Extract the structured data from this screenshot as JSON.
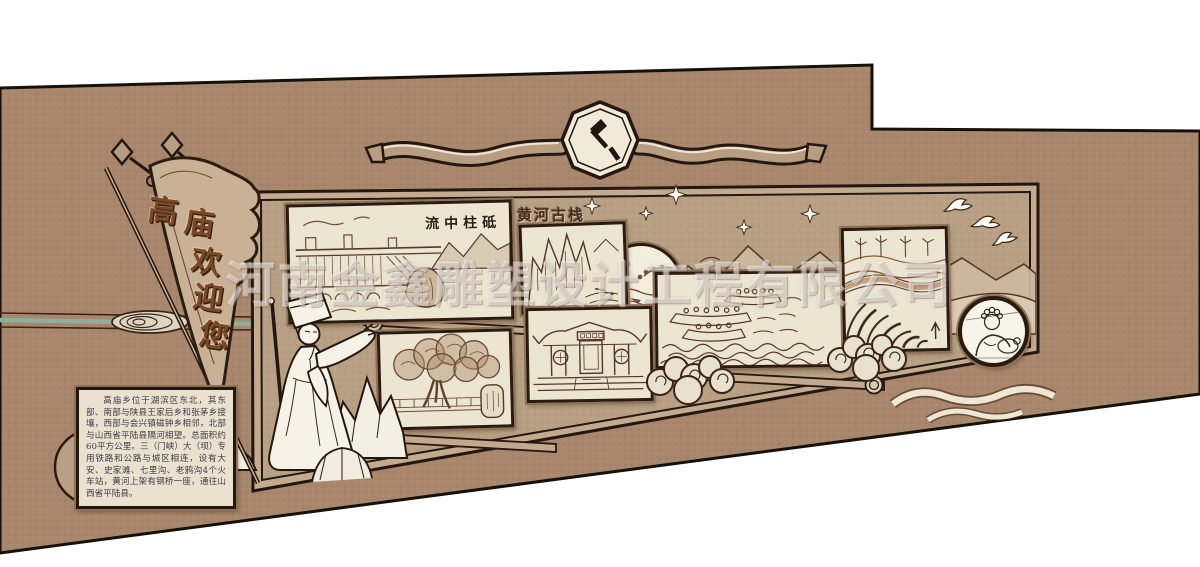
{
  "watermark": {
    "company": "河南金鑫雕塑设计工程有限公司"
  },
  "flag": {
    "text": "高庙欢迎您",
    "chars": [
      "高",
      "庙",
      "欢",
      "迎",
      "您"
    ]
  },
  "banner": {
    "emblem_icon": "hammer-sickle-icon"
  },
  "intro_board": {
    "text": "高庙乡位于湖滨区东北，其东部、南部与陕县王家后乡和张茅乡接壤，西部与会兴镇磁钟乡相邻，北部与山西省平陆县隔河相望。总面积约60平方公里。三（门峡）大（坝）专用铁路和公路与城区相连，设有大安、史家滩、七里沟、老鸦沟4个火车站，黄河上架有钢桥一座，通往山西省平陆县。"
  },
  "gallery": {
    "dam": {
      "caption": "流中柱砥",
      "subject": "dam-landscape-sketch"
    },
    "gorge": {
      "title": "黄河古栈",
      "subject": "gorge-cliff-sketch"
    },
    "vignette": {
      "subject": "round-landscape-vignette"
    },
    "temple": {
      "subject": "temple-facade-sketch"
    },
    "boats": {
      "subject": "boats-on-river-sketch"
    },
    "terraces": {
      "subject": "terraced-fields-wind-turbines-sketch"
    },
    "portrait": {
      "subject": "person-portrait-sketch"
    },
    "tree": {
      "subject": "ancient-tree-sketch"
    }
  },
  "colors": {
    "wall": "#a8876c",
    "panel": "#b7a083",
    "paper": "#ece5d2",
    "frame_border": "#2b1a10",
    "calligraphy": "#7a4928",
    "accent_teal": "#8fae9c",
    "watermark_white": "rgba(255,255,255,0.42)"
  }
}
